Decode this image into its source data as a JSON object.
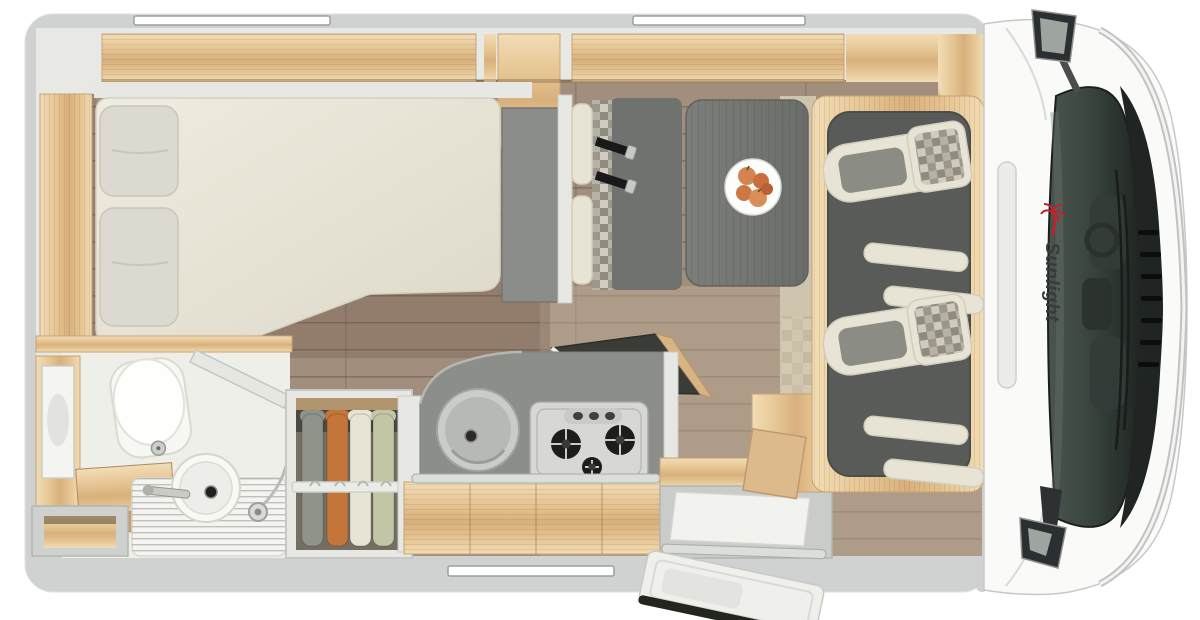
{
  "meta": {
    "title": "Motorhome floor plan - top view"
  },
  "brand": {
    "logo_text": "Sunlight"
  },
  "colors": {
    "body_wall": "#cfd2d1",
    "interior_wall": "#e8e9e5",
    "wood_light": "#f2ddb6",
    "wood_mid": "#e6c795",
    "wood_deep": "#d8b07c",
    "floor_plank": "#a28e7d",
    "floor_light": "#baa996",
    "mattress": "#ece8da",
    "upholstery_cream": "#e8e4d5",
    "upholstery_gray": "#8b8d85",
    "bench_gray": "#6f726e",
    "table_gray": "#73766f",
    "counter_gray": "#8c8e8a",
    "stove_steel": "#d7d8d4",
    "cab_floor": "#585b58",
    "windshield": "#39443e",
    "hood": "#202422",
    "chrome": "#d4d7d5",
    "logo_text": "#3a3a3c",
    "logo_palm": "#c4202e"
  },
  "windows": {
    "count": 3
  },
  "wardrobe": {
    "clothes": [
      {
        "name": "garment-gray-green",
        "color": "#8f948a"
      },
      {
        "name": "garment-orange",
        "color": "#c4763a"
      },
      {
        "name": "garment-cream",
        "color": "#e7e3d5"
      },
      {
        "name": "garment-sage",
        "color": "#c3c6a4"
      }
    ]
  },
  "dinette": {
    "fruit_colors": [
      "#d4854f",
      "#c96f3e",
      "#cb7845",
      "#d98e55",
      "#b95f35"
    ]
  }
}
